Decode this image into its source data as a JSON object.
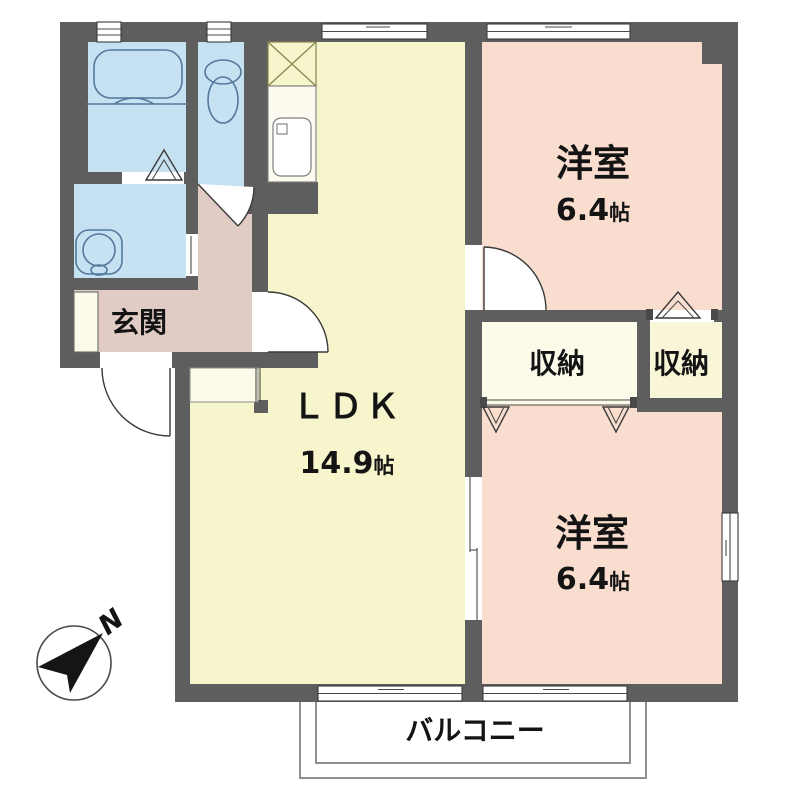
{
  "plan": {
    "type": "apartment-floor-plan",
    "rooms": {
      "room_top": {
        "name": "洋室",
        "size": "6.4",
        "unit": "帖"
      },
      "room_bottom": {
        "name": "洋室",
        "size": "6.4",
        "unit": "帖"
      },
      "ldk": {
        "name": "ＬＤＫ",
        "size": "14.9",
        "unit": "帖"
      },
      "storage_left": {
        "name": "収納"
      },
      "storage_right": {
        "name": "収納"
      },
      "entrance": {
        "name": "玄関"
      },
      "balcony": {
        "name": "バルコニー"
      }
    },
    "compass": {
      "label": "N"
    }
  },
  "colors": {
    "wall": "#5E5E5E",
    "ldk": "#F7F5CB",
    "western": "#F9DED0",
    "hall": "#E1CBC5",
    "sanitary": "#C6E1F2",
    "cream": "#FCFAE9",
    "pale_yellow": "#F9F6D8",
    "white": "#FFFFFF",
    "black": "#111111"
  }
}
